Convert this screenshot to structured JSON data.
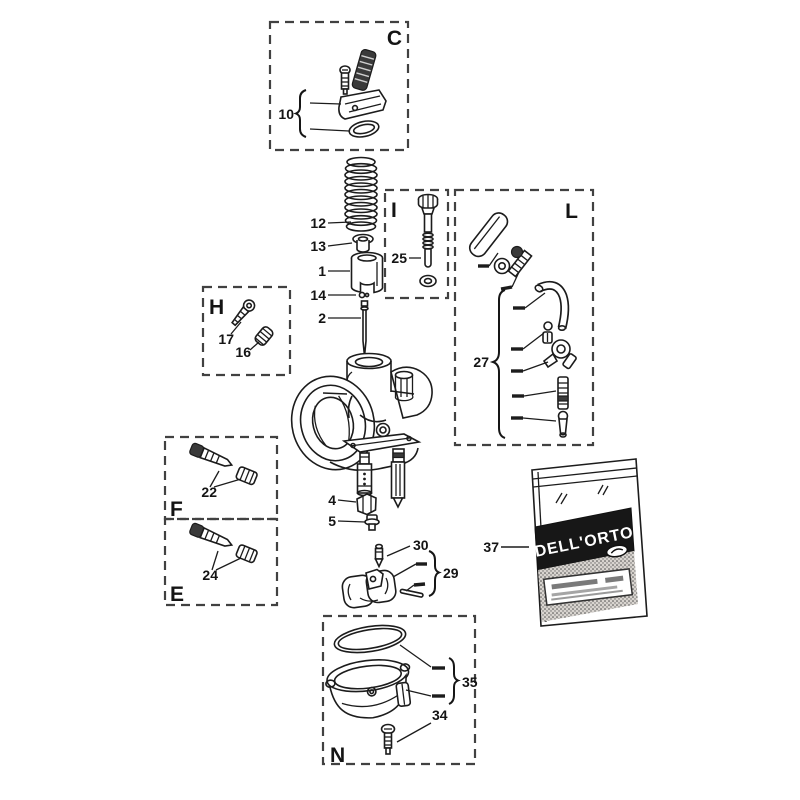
{
  "letters": {
    "c": "C",
    "i": "I",
    "l": "L",
    "h": "H",
    "f": "F",
    "e": "E",
    "n": "N"
  },
  "numbers": {
    "p1": "1",
    "p2": "2",
    "p4": "4",
    "p5": "5",
    "p10": "10",
    "p12": "12",
    "p13": "13",
    "p14": "14",
    "p16": "16",
    "p17": "17",
    "p22": "22",
    "p24": "24",
    "p25": "25",
    "p27": "27",
    "p29": "29",
    "p30": "30",
    "p34": "34",
    "p35": "35",
    "p37": "37"
  },
  "package": {
    "brand": "DELL'ORTO"
  },
  "colors": {
    "ink": "#1c1c1c",
    "box_dash": "#414141",
    "band": "#171717",
    "background": "#ffffff"
  }
}
